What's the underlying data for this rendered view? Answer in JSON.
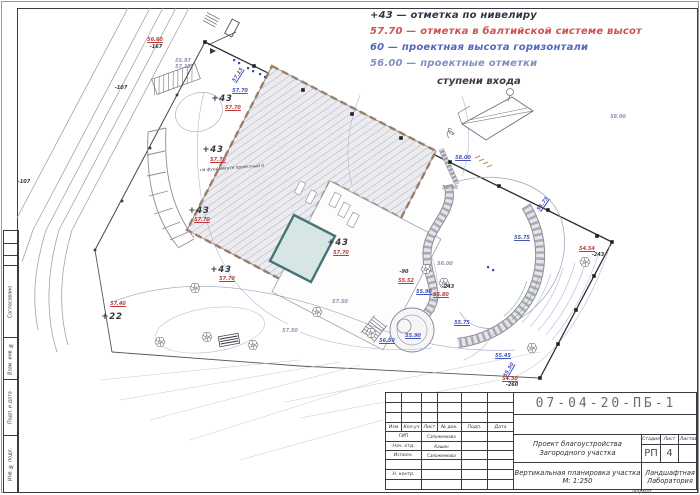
{
  "legend": {
    "items": [
      {
        "text": "+43 — отметка по нивелиру",
        "color": "#2f3542"
      },
      {
        "text": "57.70 — отметка в балтийской системе высот",
        "color": "#d05050"
      },
      {
        "text": "60 — проектная высота горизонтали",
        "color": "#5566bb"
      },
      {
        "text": "56.00 — проектные отметки",
        "color": "#8090c0"
      }
    ],
    "steps_label": "ступени входа"
  },
  "frame": {
    "side_labels": [
      "Согласовано",
      "Взам. инв. №",
      "Подп. и дата",
      "Инв. № подл."
    ]
  },
  "title_block": {
    "doc_number": "07-04-20-ПБ-1",
    "columns": [
      "Изм",
      "Кол.уч",
      "Лист",
      "№ док.",
      "Подп.",
      "Дата"
    ],
    "rows": [
      {
        "role": "ГИП",
        "name": "Сапоженкова"
      },
      {
        "role": "Нач. отд.",
        "name": "Кашин"
      },
      {
        "role": "Исполн.",
        "name": "Сапоженкова"
      },
      {
        "role": "Н. контр.",
        "name": ""
      }
    ],
    "project": "Проект благоустройства Загородного участка",
    "sheet_title": "Вертикальная планировка участка М: 1:250",
    "stage_label": "Стадия",
    "sheet_label": "Лист",
    "sheets_label": "Листов",
    "stage": "РП",
    "sheet": "4",
    "sheets": "",
    "company": "Ландшафтная Лаборатория",
    "format_label": "Формат"
  },
  "plan": {
    "building_note": "на фундаменте проектный 0",
    "colors": {
      "red": "#c23b3b",
      "blue": "#4656b8",
      "grey": "#8d96ae",
      "black": "#34363c",
      "wall_tan": "#b5916f",
      "pool": "#447676"
    },
    "marks": [
      {
        "x": 155,
        "y": 40,
        "t": "56.60",
        "c": "red"
      },
      {
        "x": 156,
        "y": 47,
        "t": "-167",
        "c": "black"
      },
      {
        "x": 121,
        "y": 88,
        "t": "-107",
        "c": "black"
      },
      {
        "x": 24,
        "y": 182,
        "t": "-107",
        "c": "black"
      },
      {
        "x": 183,
        "y": 61,
        "t": "55.97",
        "c": "grey"
      },
      {
        "x": 183,
        "y": 67,
        "t": "57.15",
        "c": "grey"
      },
      {
        "x": 238,
        "y": 75,
        "t": "57.15",
        "c": "blue",
        "r": -58
      },
      {
        "x": 240,
        "y": 91,
        "t": "57.70",
        "c": "blue"
      },
      {
        "x": 222,
        "y": 99,
        "t": "+43",
        "c": "black",
        "big": true
      },
      {
        "x": 233,
        "y": 108,
        "t": "57.70",
        "c": "red"
      },
      {
        "x": 213,
        "y": 150,
        "t": "+43",
        "c": "black",
        "big": true
      },
      {
        "x": 218,
        "y": 160,
        "t": "57.70",
        "c": "red"
      },
      {
        "x": 199,
        "y": 211,
        "t": "+43",
        "c": "black",
        "big": true
      },
      {
        "x": 202,
        "y": 220,
        "t": "57.70",
        "c": "red"
      },
      {
        "x": 221,
        "y": 270,
        "t": "+43",
        "c": "black",
        "big": true
      },
      {
        "x": 227,
        "y": 279,
        "t": "57.70",
        "c": "red"
      },
      {
        "x": 338,
        "y": 243,
        "t": "+43",
        "c": "black",
        "big": true
      },
      {
        "x": 341,
        "y": 253,
        "t": "57.70",
        "c": "red"
      },
      {
        "x": 118,
        "y": 304,
        "t": "57.40",
        "c": "red"
      },
      {
        "x": 112,
        "y": 317,
        "t": "+22",
        "c": "black",
        "big": true
      },
      {
        "x": 450,
        "y": 188,
        "t": "58.00",
        "c": "grey"
      },
      {
        "x": 618,
        "y": 117,
        "t": "58.00",
        "c": "grey"
      },
      {
        "x": 463,
        "y": 158,
        "t": "58.00",
        "c": "blue"
      },
      {
        "x": 445,
        "y": 264,
        "t": "56.00",
        "c": "grey"
      },
      {
        "x": 340,
        "y": 302,
        "t": "57.50",
        "c": "grey"
      },
      {
        "x": 290,
        "y": 331,
        "t": "57.50",
        "c": "grey"
      },
      {
        "x": 404,
        "y": 272,
        "t": "-90",
        "c": "black"
      },
      {
        "x": 406,
        "y": 281,
        "t": "55.52",
        "c": "red"
      },
      {
        "x": 424,
        "y": 292,
        "t": "55.90",
        "c": "blue"
      },
      {
        "x": 441,
        "y": 295,
        "t": "55.80",
        "c": "red"
      },
      {
        "x": 448,
        "y": 287,
        "t": "-243",
        "c": "black"
      },
      {
        "x": 522,
        "y": 238,
        "t": "55.75",
        "c": "blue"
      },
      {
        "x": 543,
        "y": 204,
        "t": "55.75",
        "c": "blue",
        "r": -55
      },
      {
        "x": 462,
        "y": 323,
        "t": "55.75",
        "c": "blue"
      },
      {
        "x": 503,
        "y": 356,
        "t": "55.45",
        "c": "blue"
      },
      {
        "x": 509,
        "y": 370,
        "t": "55.50",
        "c": "blue",
        "r": -60
      },
      {
        "x": 510,
        "y": 379,
        "t": "54.50",
        "c": "red"
      },
      {
        "x": 512,
        "y": 385,
        "t": "-260",
        "c": "black"
      },
      {
        "x": 587,
        "y": 249,
        "t": "54.54",
        "c": "red"
      },
      {
        "x": 598,
        "y": 255,
        "t": "-243",
        "c": "black"
      },
      {
        "x": 387,
        "y": 341,
        "t": "56.50",
        "c": "blue"
      },
      {
        "x": 413,
        "y": 336,
        "t": "55.90",
        "c": "blue"
      }
    ]
  }
}
